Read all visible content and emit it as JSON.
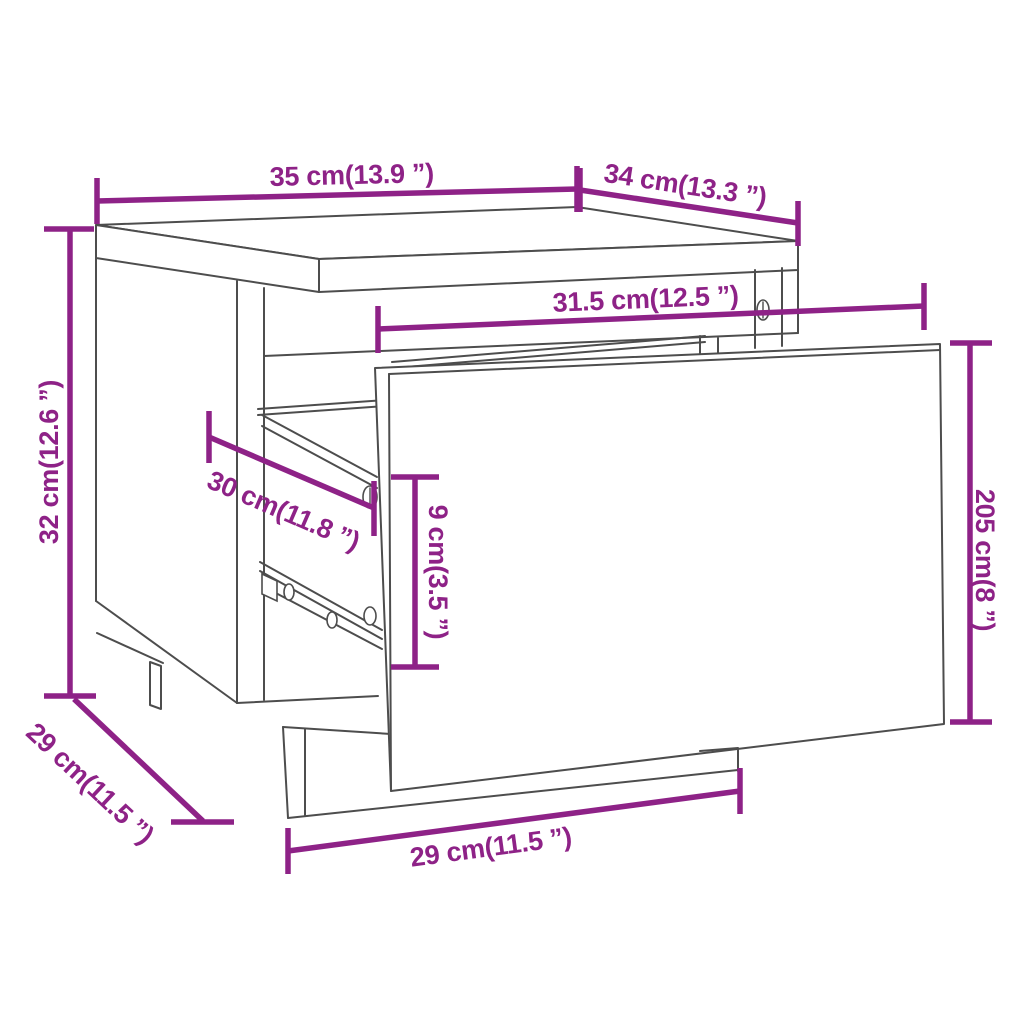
{
  "diagram": {
    "type": "furniture-dimension-diagram",
    "product": "bedside-cabinet-with-open-drawer",
    "background": "#ffffff",
    "colors": {
      "dimension_accent": "#8E2287",
      "furniture_outline": "#4d4d4d"
    },
    "dimensions": {
      "top_width": {
        "label": "35 cm(13.9 ”)"
      },
      "top_depth": {
        "label": "34 cm(13.3 ”)"
      },
      "height": {
        "label": "32 cm(12.6 ”)"
      },
      "side_depth": {
        "label": "29 cm(11.5 ”)"
      },
      "inner_width": {
        "label": "31.5 cm(12.5 ”)"
      },
      "slide_depth": {
        "label": "30 cm(11.8 ”)"
      },
      "drawer_inner_height": {
        "label": "9 cm(3.5 ”)"
      },
      "drawer_front_height": {
        "label": "205 cm(8 ”)"
      },
      "base_width": {
        "label": "29 cm(11.5 ”)"
      }
    }
  }
}
